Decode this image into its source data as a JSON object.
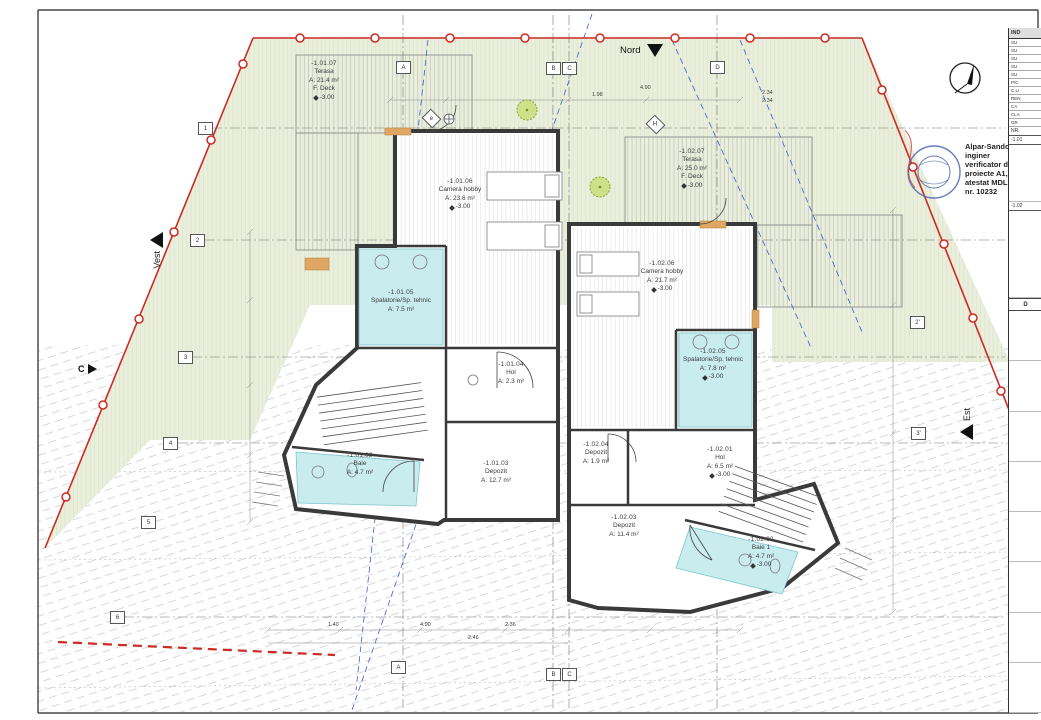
{
  "north": {
    "label": "Nord"
  },
  "west": {
    "label": "Vest"
  },
  "east": {
    "label": "Est"
  },
  "section": {
    "label": "C"
  },
  "verifier": {
    "name": "Alpar-Sandor Kis",
    "role": "inginer",
    "line3": "verificator de",
    "line4": "proiecte A1, II",
    "line5": "atestat MDLPA",
    "line6": "nr. 10232"
  },
  "grid": {
    "top": [
      "A",
      "B",
      "C",
      "D"
    ],
    "bottom": [
      "A",
      "B",
      "C"
    ],
    "left": [
      "1",
      "2",
      "3",
      "4",
      "5",
      "6"
    ],
    "right": [
      "2'",
      "3'"
    ],
    "diamond_e": "e",
    "diamond_h": "H"
  },
  "rooms": [
    {
      "id": "-1.01.07",
      "name": "Terasa",
      "area": "A: 21.4 m²",
      "finish": "F. Deck",
      "level": "-3.00"
    },
    {
      "id": "-1.02.07",
      "name": "Terasa",
      "area": "A: 25.0 m²",
      "finish": "F. Deck",
      "level": "-3.00"
    },
    {
      "id": "-1.01.06",
      "name": "Camera hobby",
      "area": "A: 23.6 m²",
      "level": "-3.00"
    },
    {
      "id": "-1.02.06",
      "name": "Camera hobby",
      "area": "A: 21.7 m²",
      "level": "-3.00"
    },
    {
      "id": "-1.01.05",
      "name": "Spalatorie/Sp. tehnic",
      "area": "A: 7.5 m²"
    },
    {
      "id": "-1.02.05",
      "name": "Spalatorie/Sp. tehnic",
      "area": "A: 7.8 m²",
      "level": "-3.00"
    },
    {
      "id": "-1.01.04",
      "name": "Hol",
      "area": "A: 2.3 m²"
    },
    {
      "id": "-1.01.02",
      "name": "Baie",
      "area": "A: 4.7 m²"
    },
    {
      "id": "-1.01.03",
      "name": "Depozit",
      "area": "A: 12.7 m²"
    },
    {
      "id": "-1.02.04",
      "name": "Depozit",
      "area": "A: 1.9 m²"
    },
    {
      "id": "-1.02.01",
      "name": "Hol",
      "area": "A: 6.5 m²",
      "level": "-3.00"
    },
    {
      "id": "-1.02.03",
      "name": "Depozit",
      "area": "A: 11.4 m²"
    },
    {
      "id": "-1.02.02",
      "name": "Baie 1",
      "area": "A: 4.7 m²",
      "level": "-3.00"
    }
  ],
  "dims": [
    "1.98",
    "4.90",
    "2.34",
    "2.34",
    "1.40",
    "4.90",
    "2.36",
    "2.46"
  ],
  "side_table": {
    "header": "IND",
    "rows": [
      "SU",
      "SU",
      "SU",
      "SU",
      "SU",
      "P/C",
      "C.U",
      "REN",
      "CA",
      "CLA",
      "GR"
    ],
    "nr_label": "NR.",
    "unit1": "-1.01",
    "unit2": "-1.02",
    "d_label": "D"
  },
  "colors": {
    "site_green": "#e9efda",
    "boundary_red": "#cc2a22",
    "wet_room_cyan": "#c9ecef",
    "wall_dark": "#3a3a3a",
    "section_blue": "#3b5ed0"
  }
}
